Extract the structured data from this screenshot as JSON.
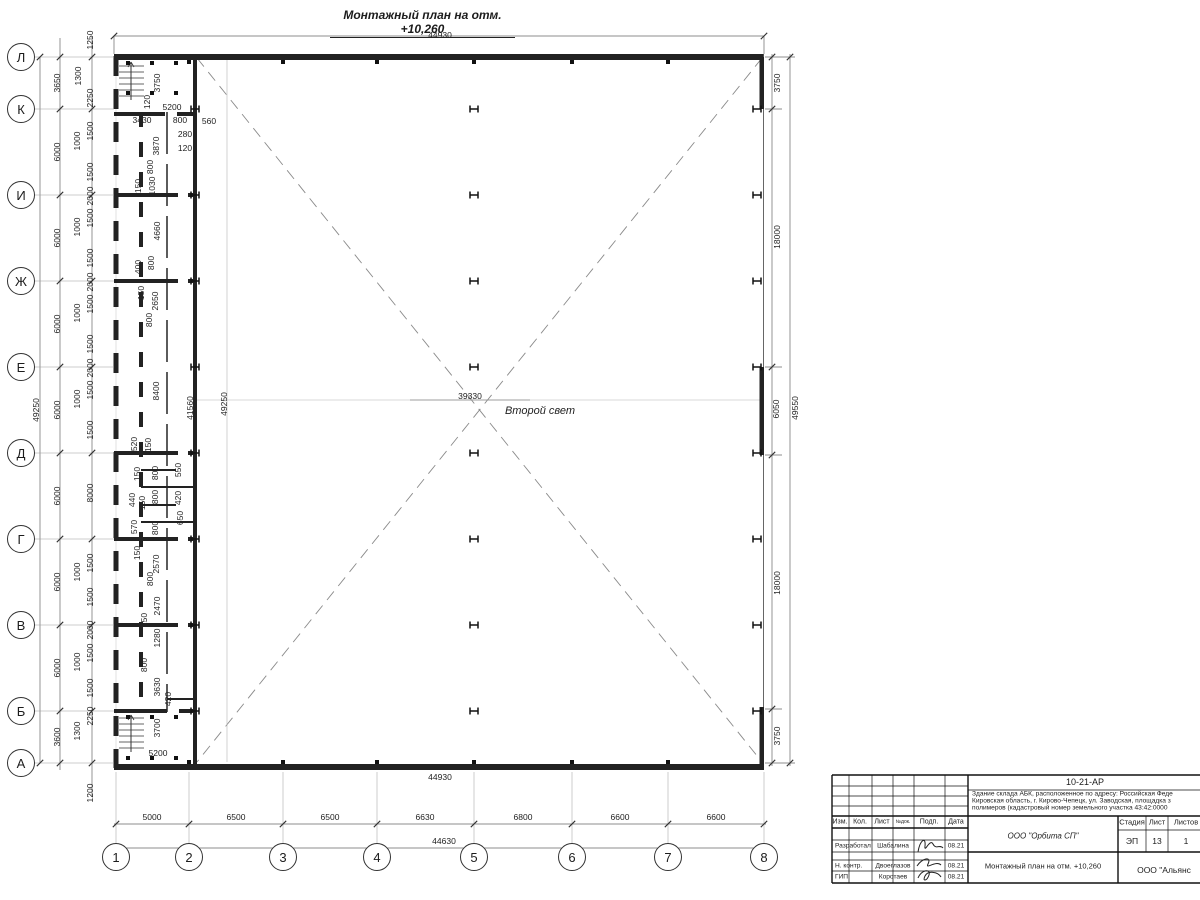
{
  "title": {
    "text": "Монтажный план на отм. +10,260"
  },
  "notes": {
    "second_light": "Второй свет"
  },
  "axes": {
    "rows": [
      {
        "label": "Л",
        "y": 57
      },
      {
        "label": "К",
        "y": 109
      },
      {
        "label": "И",
        "y": 195
      },
      {
        "label": "Ж",
        "y": 281
      },
      {
        "label": "Е",
        "y": 367
      },
      {
        "label": "Д",
        "y": 453
      },
      {
        "label": "Г",
        "y": 539
      },
      {
        "label": "В",
        "y": 625
      },
      {
        "label": "Б",
        "y": 711
      },
      {
        "label": "А",
        "y": 763
      }
    ],
    "cols": [
      {
        "label": "1",
        "x": 116
      },
      {
        "label": "2",
        "x": 189
      },
      {
        "label": "3",
        "x": 283
      },
      {
        "label": "4",
        "x": 377
      },
      {
        "label": "5",
        "x": 474
      },
      {
        "label": "6",
        "x": 572
      },
      {
        "label": "7",
        "x": 668
      },
      {
        "label": "8",
        "x": 764
      }
    ]
  },
  "plan": {
    "h_columns": {
      "xs": [
        195,
        474,
        757
      ],
      "ys": [
        109,
        195,
        281,
        367,
        453,
        539,
        625,
        711
      ]
    },
    "dim_labels": [
      {
        "t": "44930",
        "x": 440,
        "y": 35
      },
      {
        "t": "44930",
        "x": 440,
        "y": 777
      },
      {
        "t": "44630",
        "x": 444,
        "y": 841
      },
      {
        "t": "5000",
        "x": 152,
        "y": 817
      },
      {
        "t": "6500",
        "x": 236,
        "y": 817
      },
      {
        "t": "6500",
        "x": 330,
        "y": 817
      },
      {
        "t": "6630",
        "x": 425,
        "y": 817
      },
      {
        "t": "6800",
        "x": 523,
        "y": 817
      },
      {
        "t": "6600",
        "x": 620,
        "y": 817
      },
      {
        "t": "6600",
        "x": 716,
        "y": 817
      },
      {
        "t": "3650",
        "x": 57,
        "y": 83,
        "r": 1
      },
      {
        "t": "6000",
        "x": 57,
        "y": 152,
        "r": 1
      },
      {
        "t": "6000",
        "x": 57,
        "y": 238,
        "r": 1
      },
      {
        "t": "6000",
        "x": 57,
        "y": 324,
        "r": 1
      },
      {
        "t": "6000",
        "x": 57,
        "y": 410,
        "r": 1
      },
      {
        "t": "6000",
        "x": 57,
        "y": 496,
        "r": 1
      },
      {
        "t": "6000",
        "x": 57,
        "y": 582,
        "r": 1
      },
      {
        "t": "6000",
        "x": 57,
        "y": 668,
        "r": 1
      },
      {
        "t": "3600",
        "x": 57,
        "y": 737,
        "r": 1
      },
      {
        "t": "49250",
        "x": 36,
        "y": 410,
        "r": 1
      },
      {
        "t": "1250",
        "x": 90,
        "y": 40,
        "r": 1
      },
      {
        "t": "1300",
        "x": 78,
        "y": 76,
        "r": 1
      },
      {
        "t": "2250",
        "x": 90,
        "y": 98,
        "r": 1
      },
      {
        "t": "1500",
        "x": 90,
        "y": 131,
        "r": 1
      },
      {
        "t": "1000",
        "x": 77,
        "y": 141,
        "r": 1
      },
      {
        "t": "1500",
        "x": 90,
        "y": 172,
        "r": 1
      },
      {
        "t": "2000",
        "x": 90,
        "y": 196,
        "r": 1
      },
      {
        "t": "1500",
        "x": 90,
        "y": 218,
        "r": 1
      },
      {
        "t": "1000",
        "x": 77,
        "y": 227,
        "r": 1
      },
      {
        "t": "1500",
        "x": 90,
        "y": 258,
        "r": 1
      },
      {
        "t": "2000",
        "x": 90,
        "y": 282,
        "r": 1
      },
      {
        "t": "1500",
        "x": 90,
        "y": 304,
        "r": 1
      },
      {
        "t": "1000",
        "x": 77,
        "y": 313,
        "r": 1
      },
      {
        "t": "1500",
        "x": 90,
        "y": 344,
        "r": 1
      },
      {
        "t": "2000",
        "x": 90,
        "y": 368,
        "r": 1
      },
      {
        "t": "1500",
        "x": 90,
        "y": 390,
        "r": 1
      },
      {
        "t": "1000",
        "x": 77,
        "y": 399,
        "r": 1
      },
      {
        "t": "1500",
        "x": 90,
        "y": 430,
        "r": 1
      },
      {
        "t": "8000",
        "x": 90,
        "y": 493,
        "r": 1
      },
      {
        "t": "1500",
        "x": 90,
        "y": 563,
        "r": 1
      },
      {
        "t": "1000",
        "x": 77,
        "y": 572,
        "r": 1
      },
      {
        "t": "1500",
        "x": 90,
        "y": 597,
        "r": 1
      },
      {
        "t": "2000",
        "x": 90,
        "y": 630,
        "r": 1
      },
      {
        "t": "1500",
        "x": 90,
        "y": 653,
        "r": 1
      },
      {
        "t": "1000",
        "x": 77,
        "y": 662,
        "r": 1
      },
      {
        "t": "1500",
        "x": 90,
        "y": 688,
        "r": 1
      },
      {
        "t": "2250",
        "x": 90,
        "y": 716,
        "r": 1
      },
      {
        "t": "1300",
        "x": 77,
        "y": 731,
        "r": 1
      },
      {
        "t": "1200",
        "x": 90,
        "y": 793,
        "r": 1
      },
      {
        "t": "3750",
        "x": 777,
        "y": 83,
        "r": 1
      },
      {
        "t": "18000",
        "x": 777,
        "y": 237,
        "r": 1
      },
      {
        "t": "6050",
        "x": 776,
        "y": 409,
        "r": 1
      },
      {
        "t": "18000",
        "x": 777,
        "y": 583,
        "r": 1
      },
      {
        "t": "3750",
        "x": 777,
        "y": 736,
        "r": 1
      },
      {
        "t": "49550",
        "x": 795,
        "y": 408,
        "r": 1
      },
      {
        "t": "3750",
        "x": 157,
        "y": 83,
        "r": 1
      },
      {
        "t": "120",
        "x": 147,
        "y": 102,
        "r": 1
      },
      {
        "t": "5200",
        "x": 172,
        "y": 107
      },
      {
        "t": "3430",
        "x": 142,
        "y": 120
      },
      {
        "t": "800",
        "x": 180,
        "y": 120
      },
      {
        "t": "560",
        "x": 209,
        "y": 121
      },
      {
        "t": "280",
        "x": 185,
        "y": 134
      },
      {
        "t": "120",
        "x": 185,
        "y": 148
      },
      {
        "t": "3870",
        "x": 156,
        "y": 146,
        "r": 1
      },
      {
        "t": "800",
        "x": 150,
        "y": 167,
        "r": 1
      },
      {
        "t": "150",
        "x": 138,
        "y": 186,
        "r": 1
      },
      {
        "t": "1030",
        "x": 152,
        "y": 186,
        "r": 1
      },
      {
        "t": "4660",
        "x": 157,
        "y": 231,
        "r": 1
      },
      {
        "t": "400",
        "x": 138,
        "y": 267,
        "r": 1
      },
      {
        "t": "800",
        "x": 151,
        "y": 263,
        "r": 1
      },
      {
        "t": "150",
        "x": 141,
        "y": 293,
        "r": 1
      },
      {
        "t": "2650",
        "x": 155,
        "y": 301,
        "r": 1
      },
      {
        "t": "800",
        "x": 149,
        "y": 320,
        "r": 1
      },
      {
        "t": "8400",
        "x": 156,
        "y": 391,
        "r": 1
      },
      {
        "t": "41560",
        "x": 190,
        "y": 408,
        "r": 1
      },
      {
        "t": "49250",
        "x": 224,
        "y": 404,
        "r": 1
      },
      {
        "t": "39330",
        "x": 470,
        "y": 396
      },
      {
        "t": "520",
        "x": 134,
        "y": 444,
        "r": 1
      },
      {
        "t": "150",
        "x": 148,
        "y": 445,
        "r": 1
      },
      {
        "t": "150",
        "x": 137,
        "y": 474,
        "r": 1
      },
      {
        "t": "800",
        "x": 155,
        "y": 473,
        "r": 1
      },
      {
        "t": "550",
        "x": 178,
        "y": 470,
        "r": 1
      },
      {
        "t": "800",
        "x": 155,
        "y": 497,
        "r": 1
      },
      {
        "t": "420",
        "x": 178,
        "y": 498,
        "r": 1
      },
      {
        "t": "440",
        "x": 132,
        "y": 500,
        "r": 1
      },
      {
        "t": "150",
        "x": 142,
        "y": 503,
        "r": 1
      },
      {
        "t": "650",
        "x": 180,
        "y": 518,
        "r": 1
      },
      {
        "t": "570",
        "x": 134,
        "y": 527,
        "r": 1
      },
      {
        "t": "800",
        "x": 155,
        "y": 528,
        "r": 1
      },
      {
        "t": "150",
        "x": 137,
        "y": 553,
        "r": 1
      },
      {
        "t": "2570",
        "x": 156,
        "y": 564,
        "r": 1
      },
      {
        "t": "800",
        "x": 150,
        "y": 579,
        "r": 1
      },
      {
        "t": "2470",
        "x": 157,
        "y": 606,
        "r": 1
      },
      {
        "t": "150",
        "x": 144,
        "y": 620,
        "r": 1
      },
      {
        "t": "1280",
        "x": 157,
        "y": 638,
        "r": 1
      },
      {
        "t": "800",
        "x": 144,
        "y": 665,
        "r": 1
      },
      {
        "t": "3630",
        "x": 157,
        "y": 687,
        "r": 1
      },
      {
        "t": "420",
        "x": 168,
        "y": 699,
        "r": 1
      },
      {
        "t": "3700",
        "x": 157,
        "y": 728,
        "r": 1
      },
      {
        "t": "5200",
        "x": 158,
        "y": 753
      }
    ]
  },
  "titleblock": {
    "code": "10-21-АР",
    "desc_lines": [
      "Здание склада АБК, расположенное по адресу: Российская Феде",
      "Кировская область, г. Кирово-Чепецк, ул. Заводская, площадка з",
      "полимеров (кадастровый номер земельного участка 43:42:0000"
    ],
    "cols": {
      "izm": "Изм.",
      "kol": "Кол.",
      "list": "Лист",
      "ndok": "№док.",
      "podp": "Подп.",
      "data": "Дата"
    },
    "rows": [
      {
        "role": "Разработал",
        "name": "Шабалина",
        "date": "08.21"
      },
      {
        "role": "Н. контр.",
        "name": "Двоеглазов",
        "date": "08.21"
      },
      {
        "role": "ГИП",
        "name": "Коротаев",
        "date": "08.21"
      }
    ],
    "stage": {
      "h1": "Стадия",
      "h2": "Лист",
      "h3": "Листов",
      "v1": "ЭП",
      "v2": "13",
      "v3": "1"
    },
    "company": "ООО \"Орбита СП\"",
    "doc_title": "Монтажный план на отм. +10,260",
    "org": "ООО \"Альянс"
  }
}
